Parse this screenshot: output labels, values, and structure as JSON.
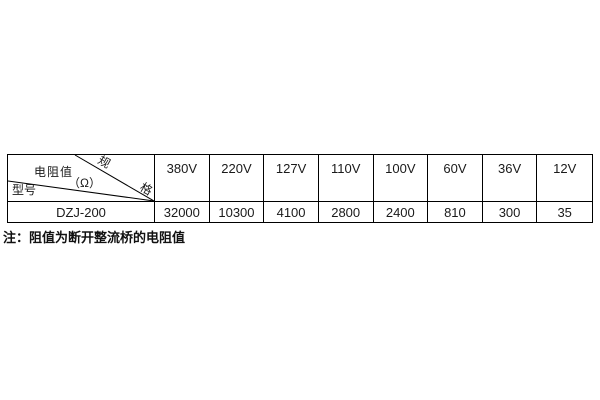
{
  "page": {
    "background": "#ffffff",
    "border_color": "#000000",
    "text_color": "#1a1a1a"
  },
  "table": {
    "corner": {
      "spec_char1": "规",
      "spec_char2": "格",
      "resistance_label": "电阻值",
      "resistance_unit": "（Ω）",
      "model_label": "型号"
    },
    "columns": [
      "380V",
      "220V",
      "127V",
      "110V",
      "100V",
      "60V",
      "36V",
      "12V"
    ],
    "rows": [
      {
        "model": "DZJ-200",
        "values": [
          "32000",
          "10300",
          "4100",
          "2800",
          "2400",
          "810",
          "300",
          "35"
        ]
      }
    ]
  },
  "note": "注：阻值为断开整流桥的电阻值"
}
